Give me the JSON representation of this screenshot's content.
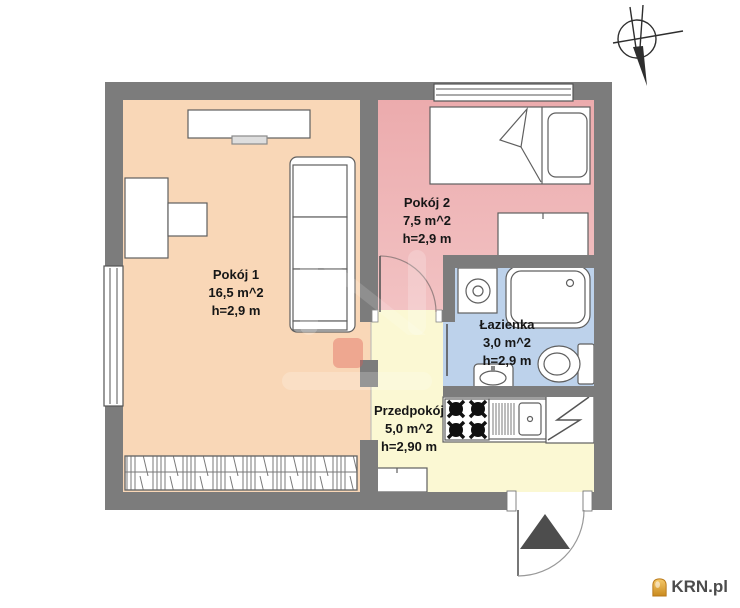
{
  "document": {
    "type": "apartment floor plan",
    "background": "#ffffff"
  },
  "rooms": [
    {
      "name": "Pokój 1",
      "area": "16,5 m^2",
      "height": "h=2,9 m"
    },
    {
      "name": "Pokój 2",
      "area": "7,5 m^2",
      "height": "h=2,9 m"
    },
    {
      "name": "Łazienka",
      "area": "3,0 m^2",
      "height": "h=2,9 m"
    },
    {
      "name": "Przedpokój",
      "area": "5,0 m^2",
      "height": "h=2,90 m"
    }
  ],
  "branding": {
    "logo_text": "KRN.pl",
    "logo_icon": "house-icon",
    "logo_text_color": "#4c4c4c",
    "logo_icon_color": "#e09a30"
  },
  "colors": {
    "wall": "#7c7c7c",
    "room1_fill": "#f9d7b7",
    "room2_fill": "#efb6b8",
    "bathroom_fill": "#bdd2eb",
    "hallway_fill": "#fbf8d3",
    "furniture_stroke": "#5f5f5f",
    "entrance_arrow": "#4d4d4d"
  },
  "symbols": {
    "compass": "north-arrow",
    "entrance": "entrance-door-with-arrow"
  }
}
